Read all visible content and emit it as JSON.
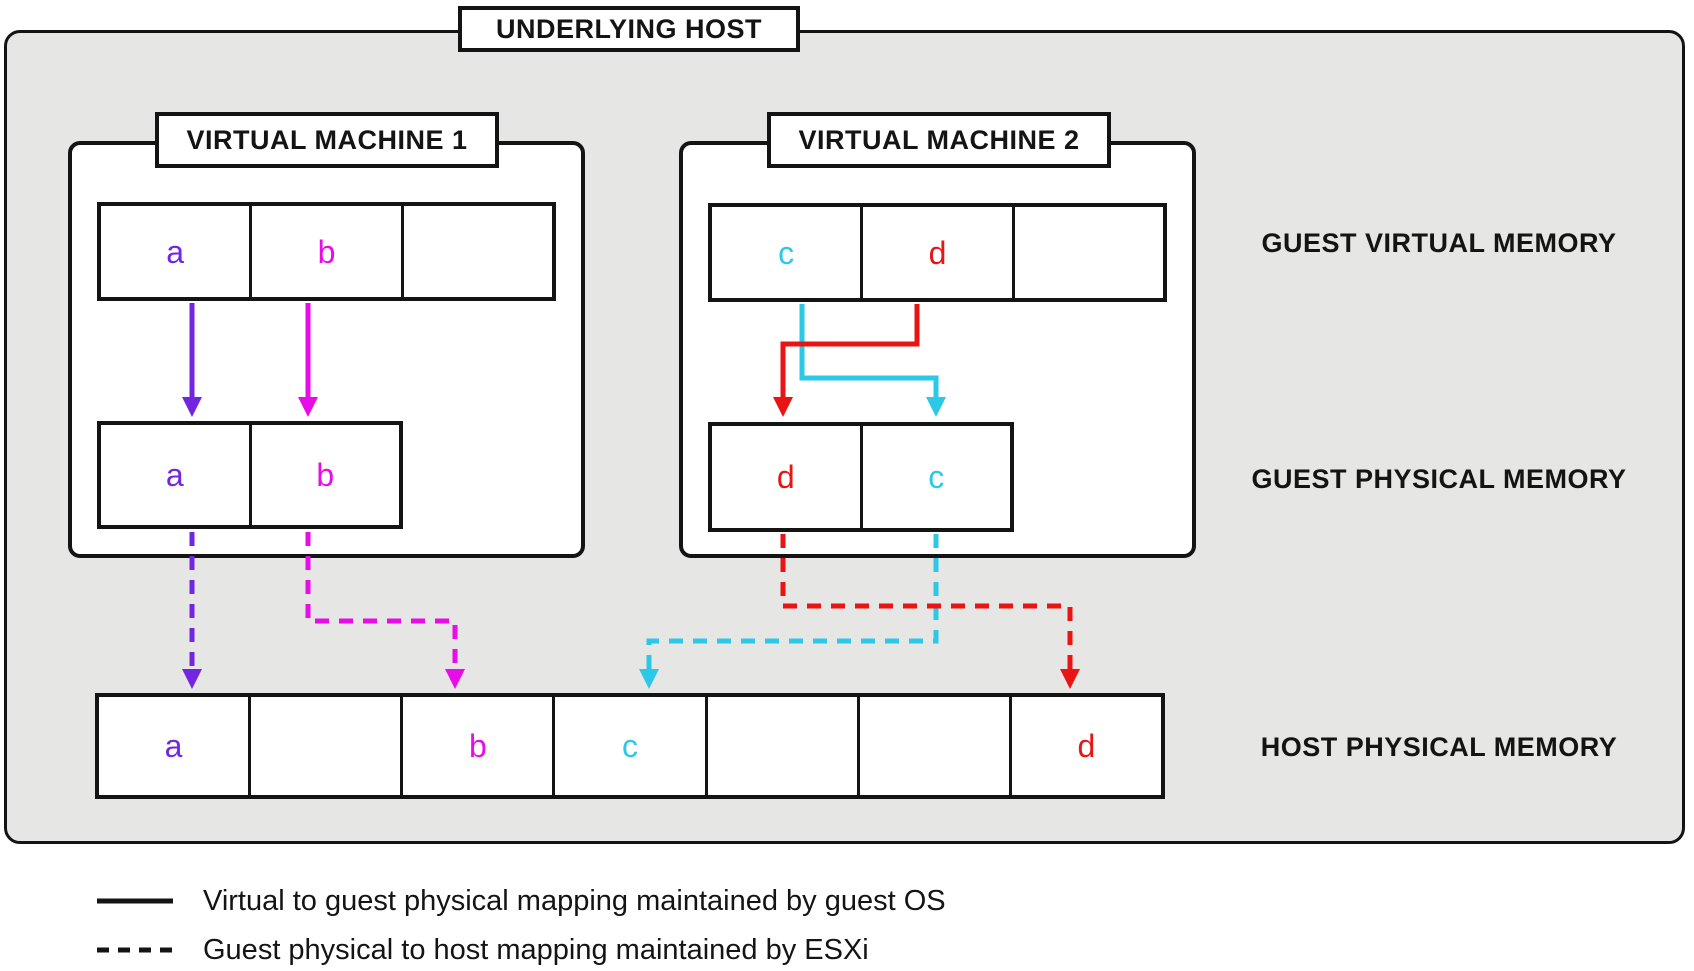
{
  "colors": {
    "purple": "#7326E0",
    "magenta": "#E80CE8",
    "cyan": "#2BC8E8",
    "red": "#E91515",
    "ink": "#141414",
    "host_bg": "#E6E6E4"
  },
  "host": {
    "title": "UNDERLYING HOST"
  },
  "vm1": {
    "title": "VIRTUAL MACHINE 1",
    "virtual_cells": [
      "a",
      "b",
      ""
    ],
    "physical_cells": [
      "a",
      "b"
    ]
  },
  "vm2": {
    "title": "VIRTUAL MACHINE 2",
    "virtual_cells": [
      "c",
      "d",
      ""
    ],
    "physical_cells": [
      "d",
      "c"
    ]
  },
  "zone_labels": {
    "guest_virtual": "GUEST VIRTUAL MEMORY",
    "guest_physical": "GUEST PHYSICAL MEMORY",
    "host_physical": "HOST PHYSICAL MEMORY"
  },
  "host_memory_cells": [
    "a",
    "",
    "b",
    "c",
    "",
    "",
    "d"
  ],
  "legend": {
    "solid_label": "Virtual to guest physical mapping maintained by guest OS",
    "dashed_label": "Guest physical to host mapping maintained by ESXi"
  }
}
